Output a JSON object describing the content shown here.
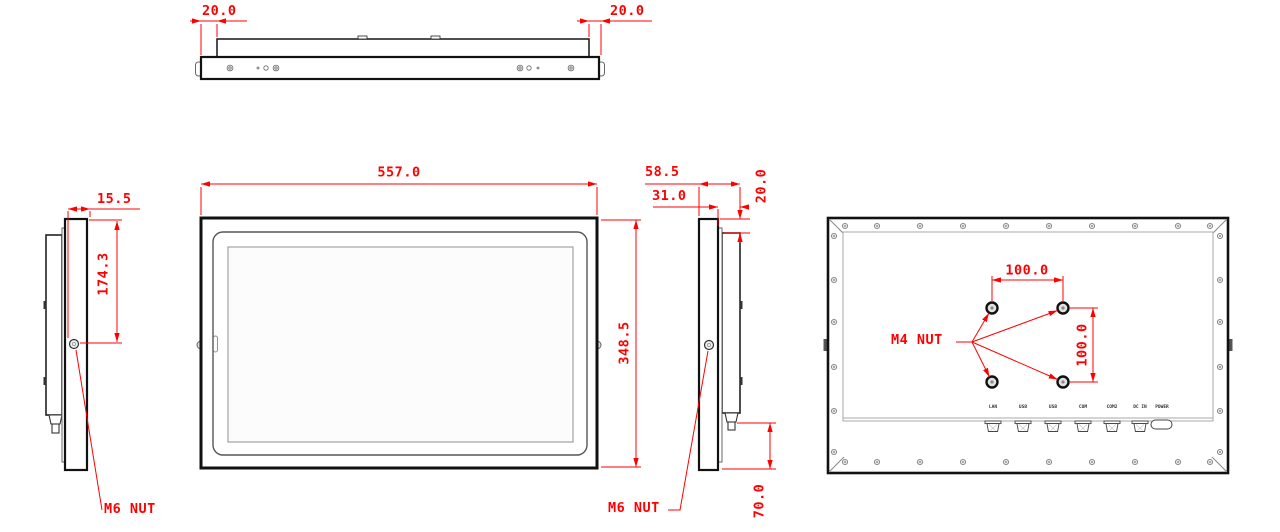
{
  "title": "Panel PC mechanical dimension drawing",
  "colors": {
    "dimension": "#ff0000",
    "outline": "#1a1a1a"
  },
  "views": {
    "top": {
      "name": "Top view",
      "dims": {
        "left_inset": "20.0",
        "right_inset": "20.0"
      }
    },
    "left_side": {
      "name": "Left side view",
      "dims": {
        "front_depth": "15.5",
        "nut_position": "174.3"
      },
      "nut_label": "M6 NUT"
    },
    "front": {
      "name": "Front view",
      "dims": {
        "width": "557.0",
        "height": "348.5"
      }
    },
    "right_side": {
      "name": "Right side view",
      "dims": {
        "total_depth": "58.5",
        "rear_depth": "31.0",
        "top_inset": "20.0",
        "bottom_offset": "70.0"
      },
      "nut_label": "M6 NUT"
    },
    "rear": {
      "name": "Rear view",
      "vesa": {
        "horizontal": "100.0",
        "vertical": "100.0"
      },
      "nut_label": "M4 NUT",
      "ports": [
        "LAN",
        "USB",
        "USB",
        "COM",
        "COM2",
        "DC IN",
        "POWER"
      ]
    }
  }
}
